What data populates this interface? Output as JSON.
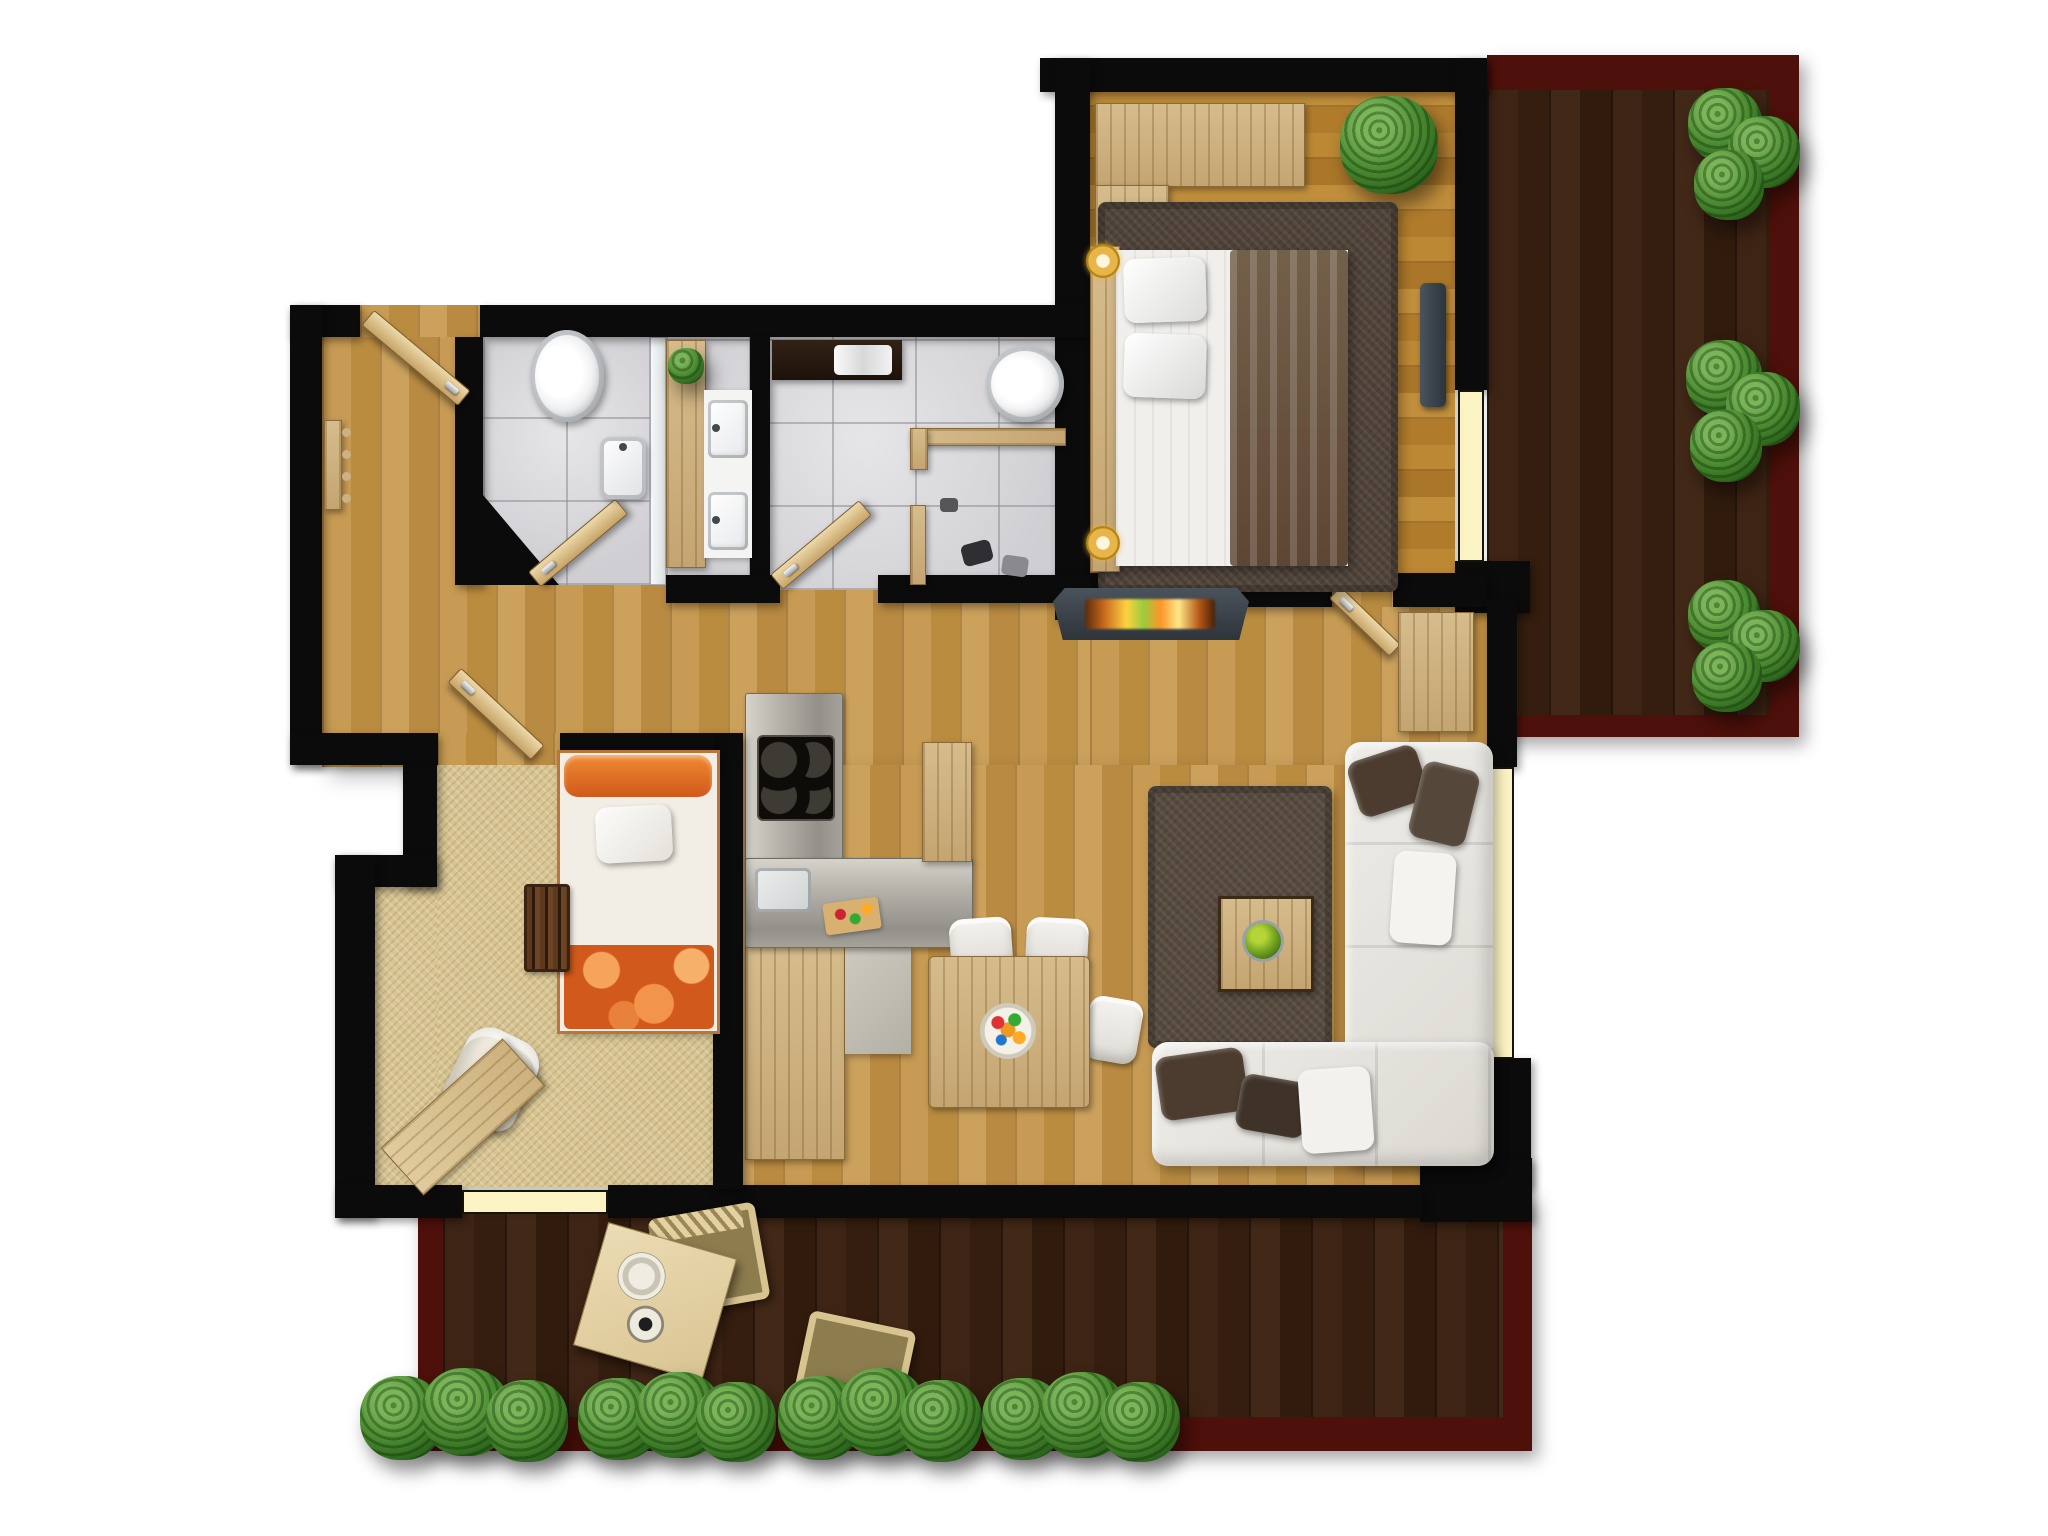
{
  "meta": {
    "type": "floor-plan",
    "description": "top-down rendered apartment floor plan with two terraces",
    "canvas": {
      "width": 2048,
      "height": 1536
    }
  },
  "palette": {
    "wall": "#0b0b0b",
    "hall_wood": "#c0944c",
    "bedroom_wood": "#bb8733",
    "terrace_deck": "#38200f",
    "terrace_border": "#4e100a",
    "tile": "#dcdcde",
    "carpet": "#d8c592",
    "window": "#fcf3c4",
    "rug": "#564a3e",
    "sofa": "#e6e4df",
    "pillow_brown": "#4c3c2f",
    "fire_glow": "#ffd23e",
    "plant_green": "#3f7d2a",
    "bed_blanket": "#6e5440",
    "kids_orange": "#d0591b",
    "kitchen_steel": "#a9a69e",
    "vanity_counter": "#f4f4f2",
    "furniture_wood": "#d6bc8c"
  },
  "rooms": [
    {
      "id": "hallway",
      "label": "hallway"
    },
    {
      "id": "wc",
      "label": "wc"
    },
    {
      "id": "bathroom",
      "label": "bathroom"
    },
    {
      "id": "bedroom",
      "label": "bedroom"
    },
    {
      "id": "kids-room",
      "label": "kids room"
    },
    {
      "id": "kitchen",
      "label": "kitchen"
    },
    {
      "id": "dining-area",
      "label": "dining area"
    },
    {
      "id": "living-room",
      "label": "living room"
    },
    {
      "id": "terrace-right",
      "label": "right terrace"
    },
    {
      "id": "terrace-bottom",
      "label": "bottom terrace"
    }
  ],
  "furniture": [
    {
      "id": "entrance-door",
      "label": "entrance door"
    },
    {
      "id": "coat-rack",
      "label": "coat rack"
    },
    {
      "id": "wc-toilet",
      "label": "toilet"
    },
    {
      "id": "wc-basin",
      "label": "hand basin"
    },
    {
      "id": "wc-door",
      "label": "wc door"
    },
    {
      "id": "vanity",
      "label": "double sink vanity"
    },
    {
      "id": "towel-shelf",
      "label": "towel shelf"
    },
    {
      "id": "bath-toilet",
      "label": "toilet"
    },
    {
      "id": "towel-rail",
      "label": "towel rail"
    },
    {
      "id": "bathroom-door",
      "label": "bathroom door"
    },
    {
      "id": "wardrobe",
      "label": "wardrobe"
    },
    {
      "id": "potted-plant",
      "label": "potted plant"
    },
    {
      "id": "double-bed",
      "label": "double bed"
    },
    {
      "id": "bedside-lamp",
      "label": "bedside lamp"
    },
    {
      "id": "tv",
      "label": "wall tv"
    },
    {
      "id": "fireplace",
      "label": "fireplace"
    },
    {
      "id": "bedroom-door",
      "label": "bedroom door"
    },
    {
      "id": "sideboard",
      "label": "sideboard"
    },
    {
      "id": "kids-bed",
      "label": "kids bed"
    },
    {
      "id": "crib-rail",
      "label": "crib rail"
    },
    {
      "id": "armchair",
      "label": "armchair"
    },
    {
      "id": "desk",
      "label": "desk"
    },
    {
      "id": "kids-room-door",
      "label": "kids room door"
    },
    {
      "id": "kitchen-counter",
      "label": "kitchen counter"
    },
    {
      "id": "cooktop",
      "label": "cooktop"
    },
    {
      "id": "kitchen-sink",
      "label": "kitchen sink"
    },
    {
      "id": "tall-cabinet",
      "label": "tall cabinet"
    },
    {
      "id": "dining-table",
      "label": "dining table"
    },
    {
      "id": "dining-chair",
      "label": "dining chair"
    },
    {
      "id": "living-rug",
      "label": "living room rug"
    },
    {
      "id": "coffee-table",
      "label": "coffee table"
    },
    {
      "id": "corner-sofa",
      "label": "corner sofa"
    },
    {
      "id": "terrace-table",
      "label": "terrace table"
    },
    {
      "id": "terrace-chair",
      "label": "terrace chair"
    },
    {
      "id": "garden-bush",
      "label": "garden bush"
    }
  ]
}
